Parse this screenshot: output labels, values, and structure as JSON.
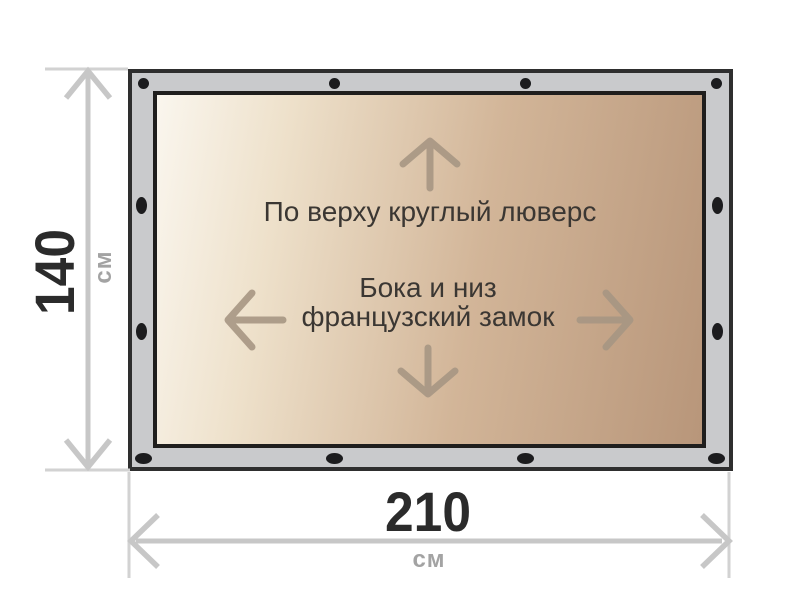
{
  "diagram": {
    "notes": {
      "top": "По верху круглый люверс",
      "middle_line1": "Бока и низ",
      "middle_line2": "французский замок"
    },
    "height_dimension": {
      "value": "140",
      "unit": "см"
    },
    "width_dimension": {
      "value": "210",
      "unit": "см"
    },
    "colors": {
      "frame_fill": "#c9cacc",
      "frame_outline": "#2e2e2e",
      "fabric_light": "#faf6ee",
      "fabric_dark": "#b8967a",
      "grommet": "#1c1c1e",
      "dimension_line": "#c7c7c7",
      "dimension_value_text": "#2b2b2b",
      "dimension_unit_text": "#a3a3a3",
      "note_text": "#3b3733",
      "direction_arrow": "#a69683"
    }
  }
}
